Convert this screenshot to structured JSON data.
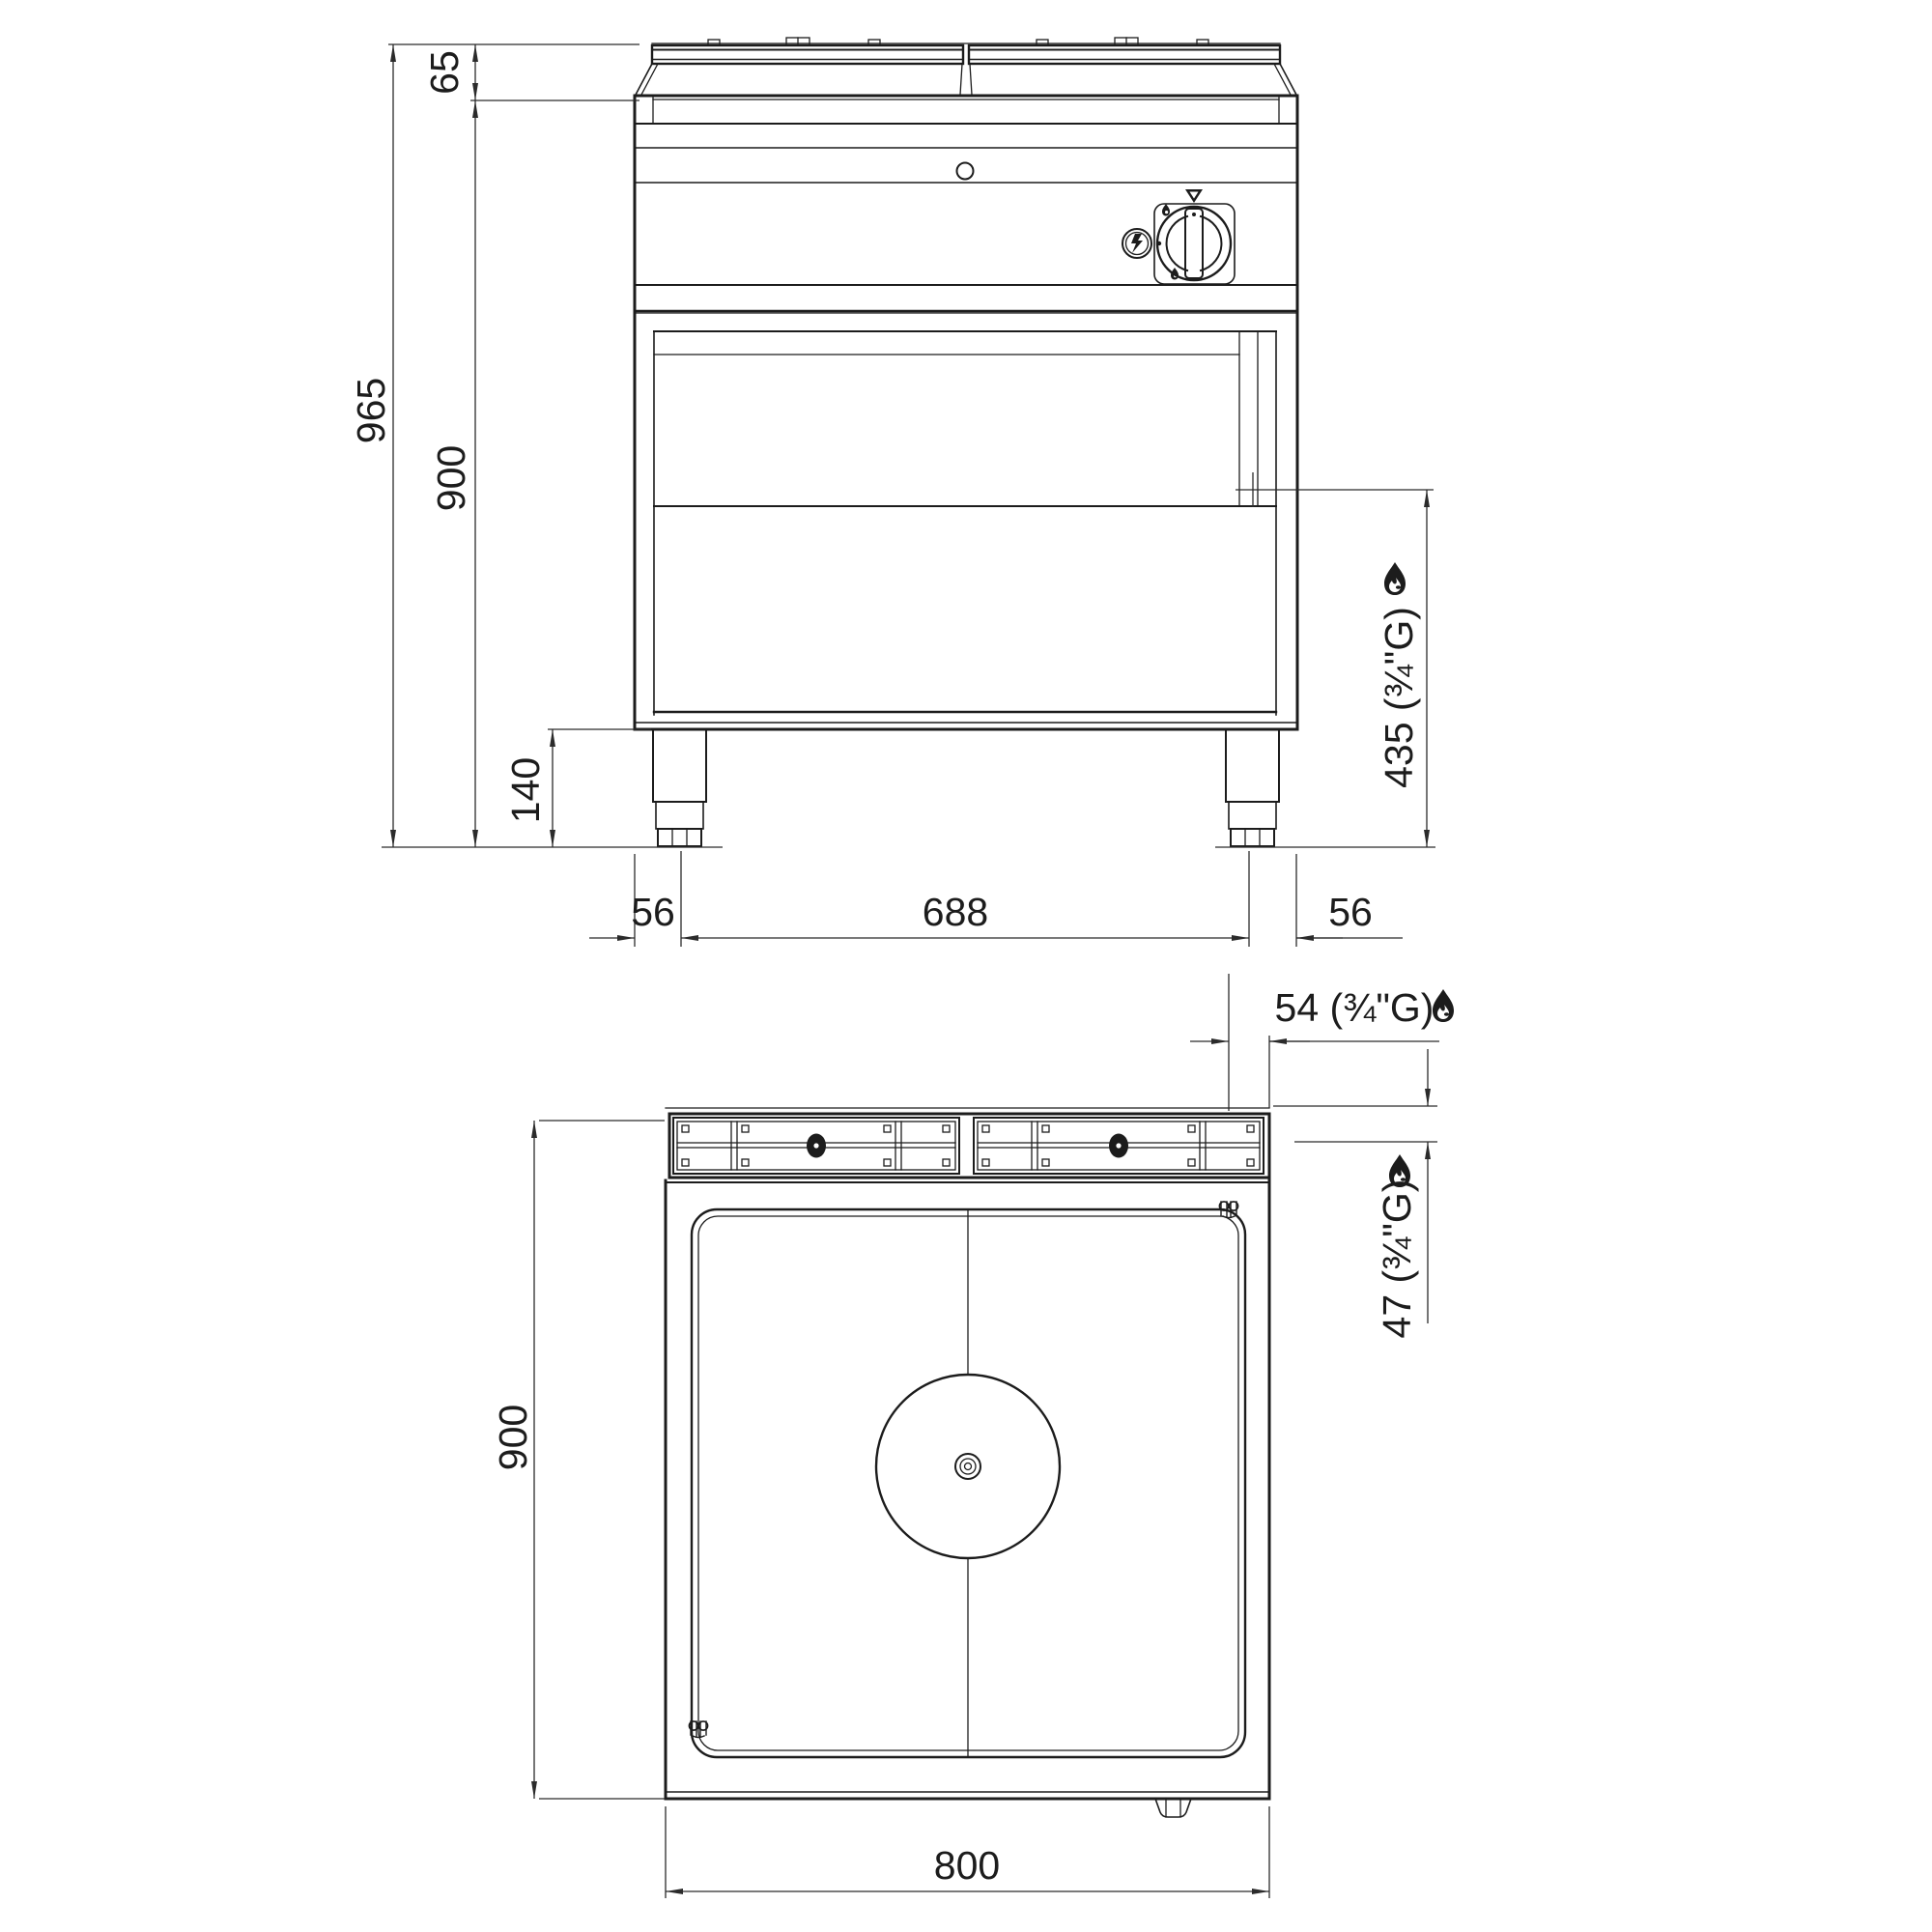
{
  "page": {
    "background": "#ffffff",
    "line_color": "#1c1c1c",
    "dimension_color": "#2b2b2b"
  },
  "drawing": {
    "type": "technical-dimension-drawing",
    "subject": "gas-solid-top-range",
    "views": [
      {
        "id": "front-view",
        "description": "front elevation with control knob, piezo igniter, legs"
      },
      {
        "id": "top-view",
        "description": "plan view with solid hot plate and centre burner ring"
      }
    ]
  },
  "dimensions": {
    "front": {
      "total_height": "965",
      "body_height": "900",
      "worktop_edge_height": "65",
      "leg_height": "140",
      "left_edge_to_leg": "56",
      "leg_span": "688",
      "leg_to_right_edge": "56",
      "gas_connection_height": "435 (¾\"G)"
    },
    "top": {
      "width": "800",
      "depth": "900",
      "gas_offset_from_right": "54 (¾\"G)",
      "gas_offset_from_back": "47 (¾\"G)"
    }
  },
  "icons": [
    {
      "name": "flame-icon",
      "meaning": "gas connection point",
      "count": 3
    },
    {
      "name": "lightning-icon",
      "meaning": "piezo igniter button"
    },
    {
      "name": "triangle-marker-icon",
      "meaning": "knob position pointer"
    },
    {
      "name": "knob-icon",
      "meaning": "gas control knob"
    },
    {
      "name": "clip-icon",
      "meaning": "fastener mark on hot plate corners",
      "count": 2
    },
    {
      "name": "burner-oval-icon",
      "meaning": "burner strip fixing",
      "count": 2
    },
    {
      "name": "bullseye-icon",
      "meaning": "centre burner ring"
    }
  ]
}
